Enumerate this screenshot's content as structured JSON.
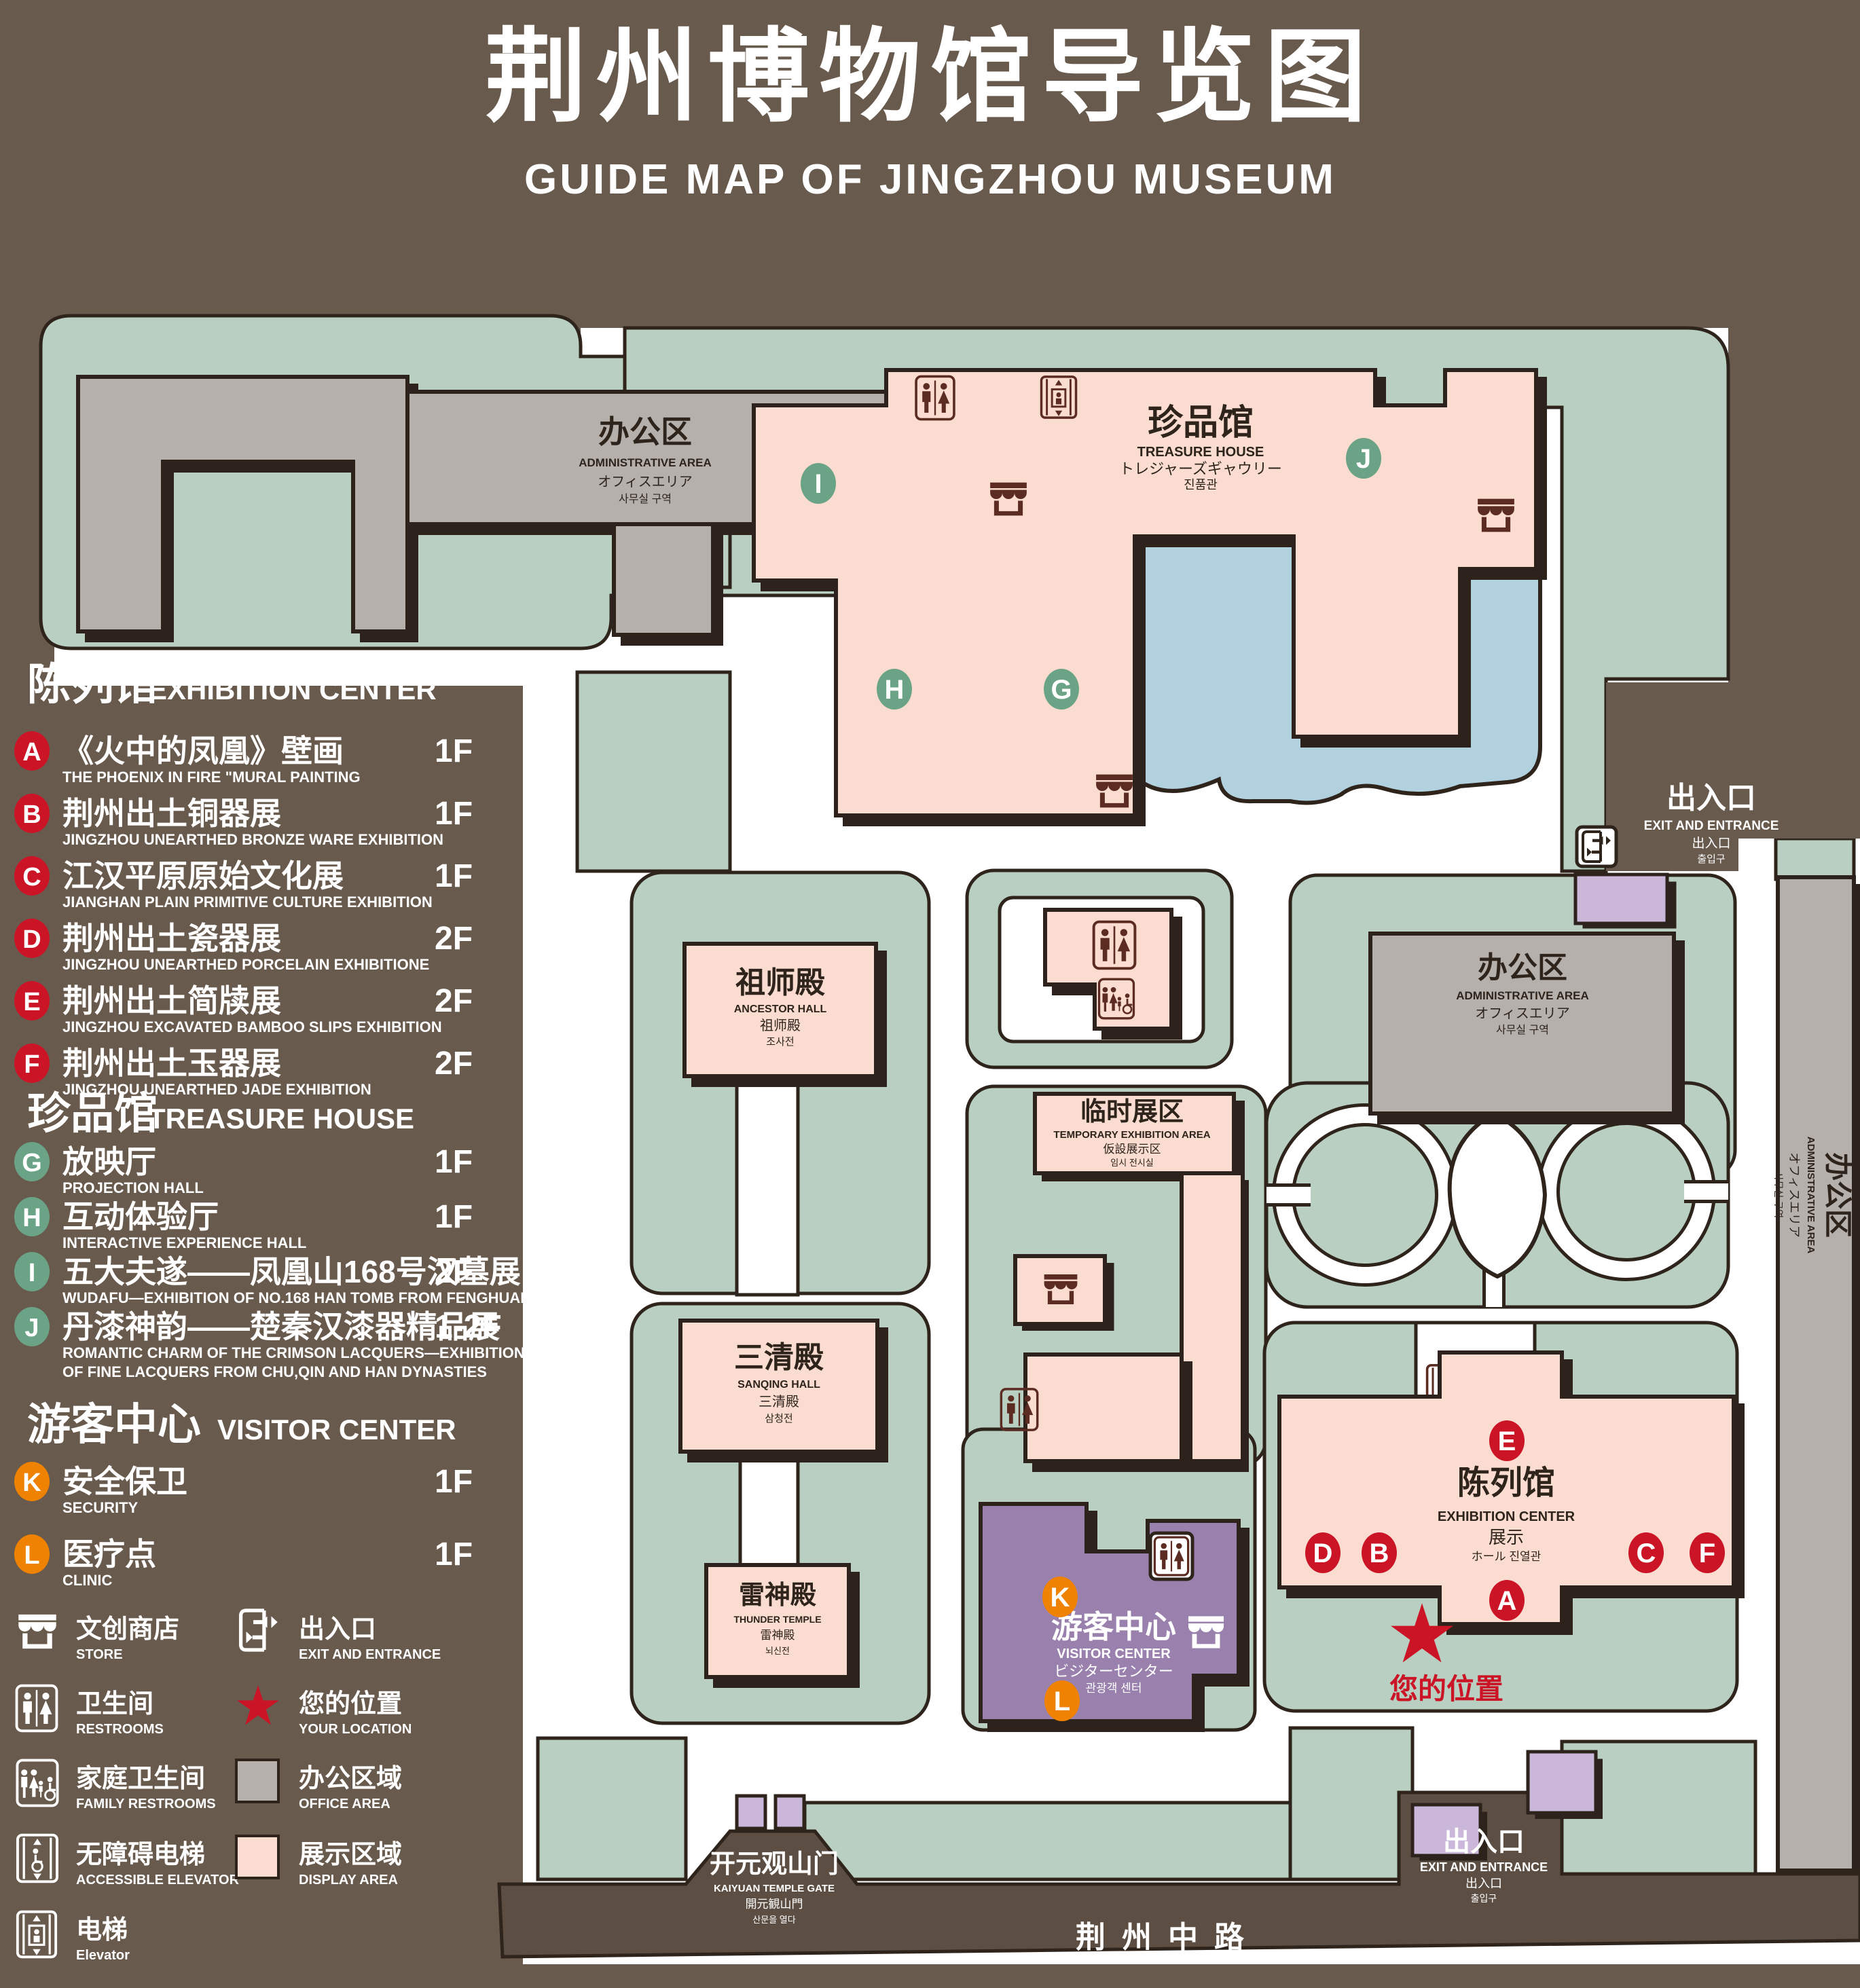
{
  "colors": {
    "page": "#695a4e",
    "road": "#5c4e43",
    "lawn": "#b8cfc1",
    "pink": "#fadcd0",
    "gray": "#b5b0ac",
    "lake": "#b2d1df",
    "purple": "#9a80ad",
    "lilac": "#cab7da",
    "ink": "#2e241c",
    "red": "#cb1426",
    "green": "#6ba387",
    "orange": "#ef8200",
    "maroon": "#5c2b21"
  },
  "title": {
    "cn": "荆州博物馆导览图",
    "en": "GUIDE MAP OF JINGZHOU MUSEUM"
  },
  "legend": {
    "sec_exhibition": {
      "cn": "陈列馆",
      "en": "EXHIBITION CENTER"
    },
    "sec_treasure": {
      "cn": "珍品馆",
      "en": "TREASURE HOUSE"
    },
    "sec_visitor": {
      "cn": "游客中心",
      "en": "VISITOR CENTER"
    },
    "items": [
      {
        "letter": "A",
        "cn": "《火中的凤凰》壁画",
        "en": "THE PHOENIX IN FIRE \"MURAL PAINTING",
        "floor": "1F"
      },
      {
        "letter": "B",
        "cn": "荆州出土铜器展",
        "en": "JINGZHOU UNEARTHED BRONZE WARE EXHIBITION",
        "floor": "1F"
      },
      {
        "letter": "C",
        "cn": "江汉平原原始文化展",
        "en": "JIANGHAN PLAIN PRIMITIVE CULTURE EXHIBITION",
        "floor": "1F"
      },
      {
        "letter": "D",
        "cn": "荆州出土瓷器展",
        "en": "JINGZHOU UNEARTHED PORCELAIN EXHIBITIONE",
        "floor": "2F"
      },
      {
        "letter": "E",
        "cn": "荆州出土简牍展",
        "en": "JINGZHOU EXCAVATED BAMBOO SLIPS EXHIBITION",
        "floor": "2F"
      },
      {
        "letter": "F",
        "cn": "荆州出土玉器展",
        "en": "JINGZHOU UNEARTHED JADE EXHIBITION",
        "floor": "2F"
      },
      {
        "letter": "G",
        "cn": "放映厅",
        "en": "PROJECTION HALL",
        "floor": "1F"
      },
      {
        "letter": "H",
        "cn": "互动体验厅",
        "en": "INTERACTIVE EXPERIENCE HALL",
        "floor": "1F"
      },
      {
        "letter": "I",
        "cn": "五大夫遂——凤凰山168号汉墓展",
        "en": "WUDAFU—EXHIBITION OF NO.168 HAN TOMB FROM FENGHUANGSHAN",
        "floor": "2F"
      },
      {
        "letter": "J",
        "cn": "丹漆神韵——楚秦汉漆器精品展",
        "en": "ROMANTIC CHARM OF THE CRIMSON LACQUERS—EXHIBITIONS",
        "en2": "OF FINE LACQUERS FROM CHU,QIN AND HAN DYNASTIES",
        "floor": "1-2F"
      },
      {
        "letter": "K",
        "cn": "安全保卫",
        "en": "SECURITY",
        "floor": "1F"
      },
      {
        "letter": "L",
        "cn": "医疗点",
        "en": "CLINIC",
        "floor": "1F"
      }
    ],
    "symbols": {
      "store": {
        "cn": "文创商店",
        "en": "STORE"
      },
      "exit": {
        "cn": "出入口",
        "en": "EXIT AND ENTRANCE"
      },
      "restrooms": {
        "cn": "卫生间",
        "en": "RESTROOMS"
      },
      "location": {
        "cn": "您的位置",
        "en": "YOUR LOCATION"
      },
      "family": {
        "cn": "家庭卫生间",
        "en": "FAMILY RESTROOMS"
      },
      "office": {
        "cn": "办公区域",
        "en": "OFFICE AREA"
      },
      "accessible": {
        "cn": "无障碍电梯",
        "en": "ACCESSIBLE ELEVATOR"
      },
      "display": {
        "cn": "展示区域",
        "en": "DISPLAY AREA"
      },
      "elevator": {
        "cn": "电梯",
        "en": "Elevator"
      }
    }
  },
  "map": {
    "admin_tl": {
      "cn": "办公区",
      "en": "ADMINISTRATIVE AREA",
      "jp": "オフィスエリア",
      "kr": "사무실 구역"
    },
    "admin_right": {
      "cn": "办公区",
      "en": "ADMINISTRATIVE AREA",
      "jp": "オフィスエリア",
      "kr": "사무실 구역"
    },
    "admin_strip": {
      "cn": "办公区",
      "en": "ADMINISTRATIVE AREA",
      "jp": "オフィスエリア",
      "kr": "사무실 구역"
    },
    "treasure": {
      "cn": "珍品馆",
      "en": "TREASURE HOUSE",
      "jp": "トレジャーズギャウリー",
      "kr": "진품관"
    },
    "ancestor": {
      "cn": "祖师殿",
      "en": "ANCESTOR HALL",
      "cn2": "祖师殿",
      "kr": "조사전"
    },
    "sanqing": {
      "cn": "三清殿",
      "en": "SANQING HALL",
      "cn2": "三清殿",
      "kr": "삼청전"
    },
    "thunder": {
      "cn": "雷神殿",
      "en": "THUNDER TEMPLE",
      "cn2": "雷神殿",
      "kr": "뇌신전"
    },
    "temporary": {
      "cn": "临时展区",
      "en": "TEMPORARY EXHIBITION AREA",
      "jp": "仮設展示区",
      "kr": "임시 전시실"
    },
    "visitor": {
      "cn": "游客中心",
      "en": "VISITOR CENTER",
      "jp": "ビジターセンター",
      "kr": "관광객 센터"
    },
    "exhibition": {
      "cn": "陈列馆",
      "en": "EXHIBITION CENTER",
      "l3": "展示",
      "l4": "ホール 진열관"
    },
    "exit_right": {
      "cn": "出入口",
      "en": "EXIT AND ENTRANCE",
      "jp": "出入口",
      "kr": "출입구"
    },
    "exit_bottom": {
      "cn": "出入口",
      "en": "EXIT AND ENTRANCE",
      "jp": "出入口",
      "kr": "출입구"
    },
    "gate": {
      "cn": "开元观山门",
      "en": "KAIYUAN TEMPLE GATE",
      "jp": "開元観山門",
      "kr": "산문을 열다"
    },
    "road": "荆州中路",
    "your_location": "您的位置",
    "star": "★"
  }
}
